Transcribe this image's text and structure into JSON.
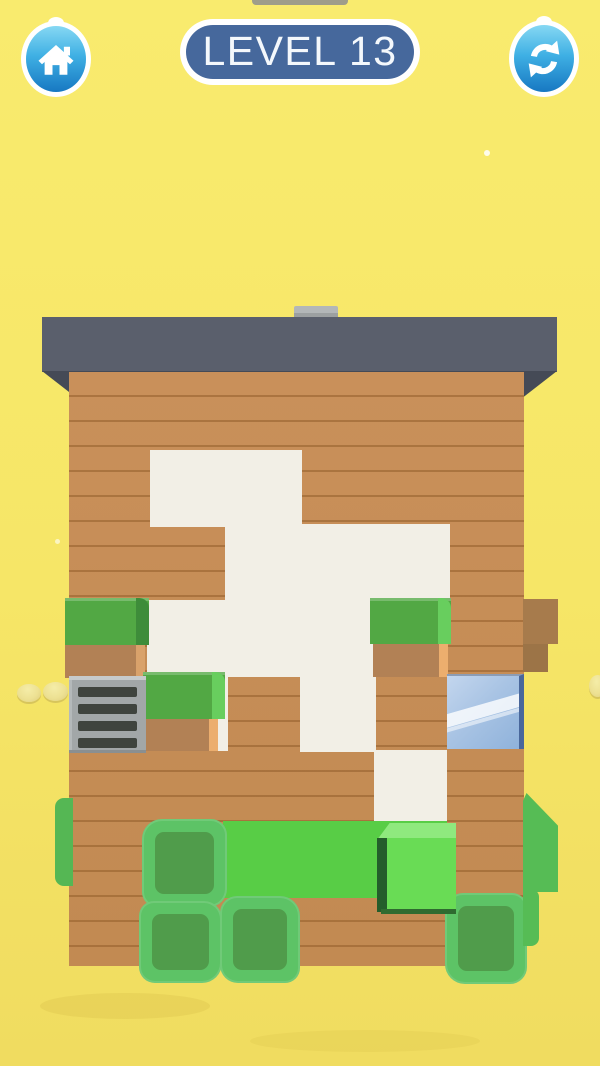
{
  "app": {
    "name": "wood carving puzzle game",
    "type": "mobile game screenshot"
  },
  "header": {
    "level_label": "LEVEL 13",
    "home_button": {
      "icon": "home-icon"
    },
    "restart_button": {
      "icon": "restart-icon"
    }
  },
  "palette": {
    "background_yellow": "#F9EB6E",
    "roof_slate": "#5A5F6C",
    "roof_underside": "#454A56",
    "wood_plank": "#C68E55",
    "plank_line": "#A9763F",
    "carved_white": "#F2EFE6",
    "bush_green": "#52A844",
    "bush_green_highlight": "#68CE5E",
    "bush_dirt": "#B28155",
    "hedge_outer_green": "#5DC366",
    "hedge_inner_green": "#509C4B",
    "platform_green": "#58CD46",
    "cube_green": "#69DC55",
    "window_glass": "#A9C4E4",
    "window_frame": "#49679B",
    "grate_gray": "#A2A7A8",
    "grate_slat": "#3F443E",
    "button_blue_top": "#86D8F3",
    "button_blue_bottom": "#1778C2",
    "pill_blue": "#46689C"
  },
  "scene": {
    "structure": "wooden cabin with dark slate roof and chimney, partially carved/scraped white area in planks",
    "carved_cells_grid_75px": [
      "row1: col2-col3",
      "row2: col3-col5",
      "row3: col2-col4",
      "row4: col4",
      "row5: col5"
    ],
    "objects": [
      "chimney",
      "roof",
      "plank-wall",
      "carved-white-region",
      "grass-block-left (green + dirt)",
      "grass-block-middle (green + dirt)",
      "grass-block-right (green + dirt)",
      "ventilation-grate (4 slats)",
      "window (blue glass, diagonal reflections)",
      "side-dirt-block-right",
      "green-platform",
      "green-3d-cube",
      "hedge-block x4 (crinkly square bushes)",
      "side-hedge-slivers x3",
      "coins x3 (pale yellow)",
      "white-flecks x2",
      "gray-top-sliver"
    ]
  }
}
